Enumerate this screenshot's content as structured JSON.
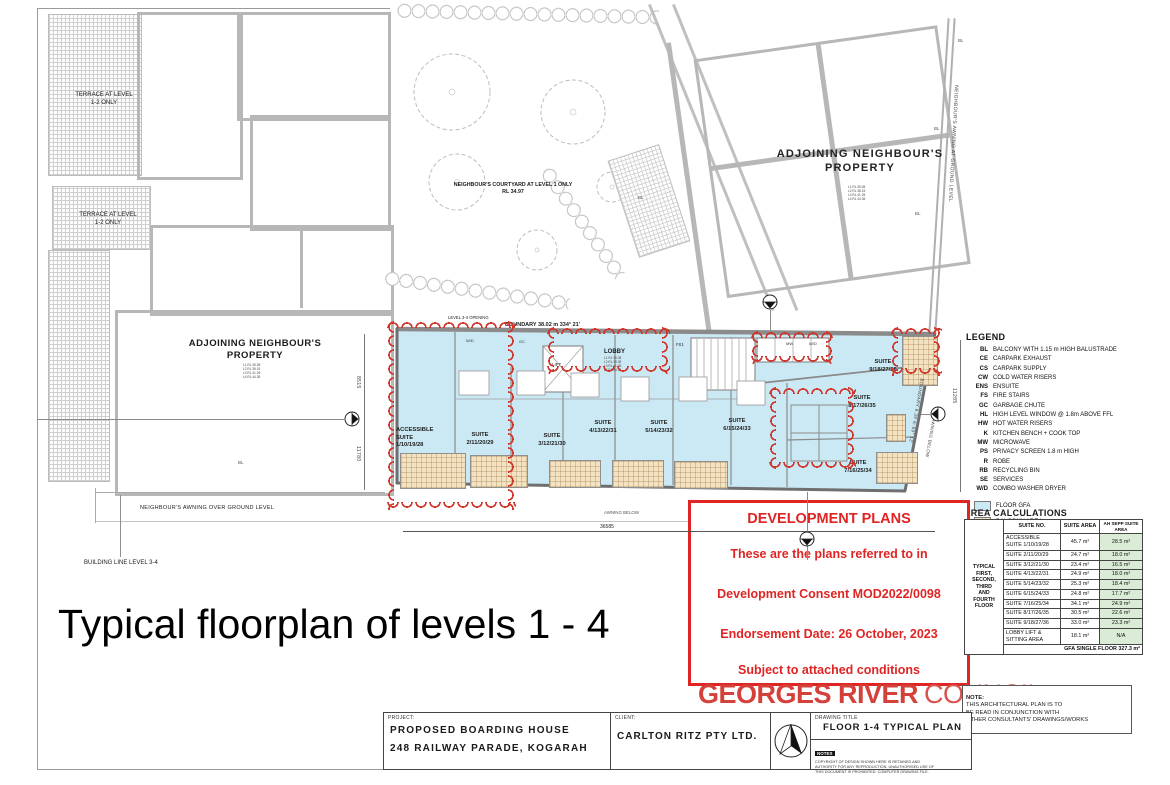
{
  "page": {
    "caption": "Typical floorplan of levels 1 - 4"
  },
  "colors": {
    "accent_red": "#e02424",
    "council_red": "#d4403a",
    "cloud_red": "#cf372c",
    "floor_gfa": "#cbe9f4",
    "balcony": "#f3e3c3",
    "table_green": "#daecd6"
  },
  "context": {
    "terrace_label": "TERRACE AT LEVEL\n1-2 ONLY",
    "adjoining_left": "ADJOINING NEIGHBOUR'S\nPROPERTY",
    "adjoining_left_rl": "L1 RL 35.05\nL2 RL 38.15\nL3 RL 41.25\nL4 RL 44.35",
    "adjoining_right": "ADJOINING NEIGHBOUR'S\nPROPERTY",
    "adjoining_right_rl": "L1 RL 35.05\nL2 RL 38.15\nL3 RL 41.25\nL4 RL 44.35",
    "courtyard": "NEIGHBOUR'S COURTYARD AT LEVEL 1 ONLY\nRL 34.97",
    "awning_right": "NEIGHBOUR'S AWNING AT GROUND LEVEL",
    "awning_over": "NEIGHBOUR'S AWNING OVER GROUND LEVEL",
    "building_line": "BUILDING LINE LEVEL 3-4",
    "bl": "BL"
  },
  "plan": {
    "boundary_top": "BOUNDARY 38.02 m    334° 21'",
    "boundary_right": "BOUNDARY 8.39 m  59° 12'",
    "opening": "LEVEL 3-4 OPENING",
    "awning_below": "AWNING BELOW",
    "dims": {
      "bottom": "36585",
      "left_upper": "8515",
      "left_lower": "11780",
      "right": "11285"
    },
    "lobby": "LOBBY",
    "lobby_rl": "L1 RL 35.35\nL2 RL 38.35\nL3 RL 41.35\nL4 RL 44.35",
    "lift": "LIFT",
    "fs1": "FS1",
    "tags": {
      "wd": "W/D",
      "gc": "GC",
      "mw": "MW"
    },
    "suites": [
      {
        "label": "ACCESSIBLE\nSUITE\n1/10/19/28"
      },
      {
        "label": "SUITE\n2/11/20/29"
      },
      {
        "label": "SUITE\n3/12/21/30"
      },
      {
        "label": "SUITE\n4/13/22/31"
      },
      {
        "label": "SUITE\n5/14/23/32"
      },
      {
        "label": "SUITE\n6/15/24/33"
      },
      {
        "label": "SUITE\n7/16/25/34"
      },
      {
        "label": "SUITE\n8/17/26/35"
      },
      {
        "label": "SUITE\n9/18/27/36"
      }
    ]
  },
  "stamp": {
    "title": "DEVELOPMENT PLANS",
    "line1": "These are the plans referred to in",
    "line2": "Development Consent MOD2022/0098",
    "line3": "Endorsement Date: 26 October, 2023",
    "line4": "Subject to attached conditions"
  },
  "council": {
    "name_bold": "GEORGES RIVER",
    "name_light": "COUNCIL"
  },
  "legend": {
    "title": "LEGEND",
    "items": [
      {
        "abbr": "BL",
        "text": "BALCONY WITH 1.15 m HIGH BALUSTRADE"
      },
      {
        "abbr": "CE",
        "text": "CARPARK EXHAUST"
      },
      {
        "abbr": "CS",
        "text": "CARPARK SUPPLY"
      },
      {
        "abbr": "CW",
        "text": "COLD WATER RISERS"
      },
      {
        "abbr": "ENS",
        "text": "ENSUITE"
      },
      {
        "abbr": "FS",
        "text": "FIRE STAIRS"
      },
      {
        "abbr": "GC",
        "text": "GARBAGE CHUTE"
      },
      {
        "abbr": "HL",
        "text": "HIGH LEVEL WINDOW @ 1.8m ABOVE FFL"
      },
      {
        "abbr": "HW",
        "text": "HOT WATER RISERS"
      },
      {
        "abbr": "K",
        "text": "KITCHEN BENCH + COOK TOP"
      },
      {
        "abbr": "MW",
        "text": "MICROWAVE"
      },
      {
        "abbr": "PS",
        "text": "PRIVACY SCREEN 1.8 m HIGH"
      },
      {
        "abbr": "R",
        "text": "ROBE"
      },
      {
        "abbr": "RB",
        "text": "RECYCLING BIN"
      },
      {
        "abbr": "SE",
        "text": "SERVICES"
      },
      {
        "abbr": "W/D",
        "text": "COMBO WASHER DRYER"
      }
    ],
    "swatches": [
      {
        "label": "FLOOR GFA",
        "color": "#cbe9f4"
      },
      {
        "label": "BALCONY AREA",
        "color": "#f3e3c3"
      }
    ]
  },
  "area_table": {
    "title": "AREA CALCULATIONS",
    "side": "TYPICAL\nFIRST,\nSECOND,\nTHIRD\nAND\nFOURTH\nFLOOR",
    "headers": [
      "SUITE NO.",
      "SUITE AREA",
      "AH SEPP SUITE\nAREA"
    ],
    "rows": [
      {
        "suite": "ACCESSIBLE\nSUITE 1/10/19/28",
        "area": "45.7 m²",
        "sepp": "28.5 m²"
      },
      {
        "suite": "SUITE 2/11/20/29",
        "area": "24.7 m²",
        "sepp": "18.0 m²"
      },
      {
        "suite": "SUITE 3/12/21/30",
        "area": "23.4 m²",
        "sepp": "16.5 m²"
      },
      {
        "suite": "SUITE 4/13/22/31",
        "area": "24.9 m²",
        "sepp": "18.0 m²"
      },
      {
        "suite": "SUITE 5/14/23/32",
        "area": "25.3 m²",
        "sepp": "18.4 m²"
      },
      {
        "suite": "SUITE 6/15/24/33",
        "area": "24.8 m²",
        "sepp": "17.7 m²"
      },
      {
        "suite": "SUITE 7/16/25/34",
        "area": "34.1 m²",
        "sepp": "24.9 m²"
      },
      {
        "suite": "SUITE 8/17/26/35",
        "area": "30.5 m²",
        "sepp": "22.6 m²"
      },
      {
        "suite": "SUITE 9/18/27/36",
        "area": "33.0 m²",
        "sepp": "23.3 m²"
      },
      {
        "suite": "LOBBY LIFT &\nSITTING AREA",
        "area": "18.1 m²",
        "sepp": "N/A"
      }
    ],
    "footer": "GFA SINGLE FLOOR 327.3 m²"
  },
  "note": {
    "label": "NOTE:",
    "text": "THIS ARCHITECTURAL PLAN IS TO\nBE READ IN CONJUNCTION WITH\nOTHER CONSULTANTS' DRAWINGS/WORKS"
  },
  "titleblock": {
    "project_label": "PROJECT:",
    "project_line1": "PROPOSED BOARDING HOUSE",
    "project_line2": "248 RAILWAY PARADE, KOGARAH",
    "client_label": "CLIENT:",
    "client_name": "CARLTON RITZ PTY LTD.",
    "drawing_title_label": "DRAWING  TITLE",
    "drawing_title": "FLOOR 1-4 TYPICAL PLAN",
    "notes_label": "NOTES",
    "notes_text": "COPYRIGHT OF DESIGN SHOWN HERE IS RETAINED AND\nAUTHORITY FOR ANY REPRODUCTION. UNAUTHORISED USE OF\nTHIS DOCUMENT IS PROHIBITED. COMPUTER DRAWING FILE."
  }
}
